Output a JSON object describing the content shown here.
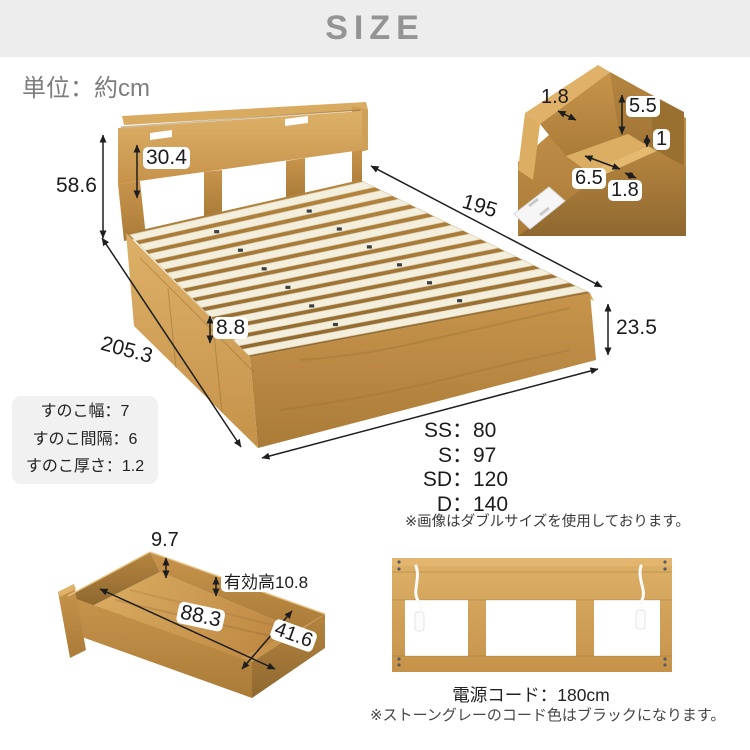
{
  "header": {
    "title": "SIZE"
  },
  "unit_label": "単位：約cm",
  "bed": {
    "total_height": "58.6",
    "headboard_height": "30.4",
    "inner_length": "195",
    "base_height": "23.5",
    "slat_rise": "8.8",
    "total_length": "205.3",
    "widths": [
      {
        "k": "SS",
        "c": "：",
        "v": "80"
      },
      {
        "k": "S",
        "c": "：",
        "v": "97"
      },
      {
        "k": "SD",
        "c": "：",
        "v": "120"
      },
      {
        "k": "D",
        "c": "：",
        "v": "140"
      }
    ],
    "image_note": "※画像はダブルサイズを使用しております。"
  },
  "slat_box": {
    "lines": [
      "すのこ幅：7",
      "すのこ間隔：6",
      "すのこ厚さ：1.2"
    ]
  },
  "corner_detail": {
    "back_thickness": "1.8",
    "shelf_inner_height": "5.5",
    "ledge_step": "1",
    "shelf_depth": "6.5",
    "front_thickness": "1.8"
  },
  "drawer": {
    "wall_height": "9.7",
    "inner_height": "有効高10.8",
    "length": "88.3",
    "width": "41.6"
  },
  "rear": {
    "cord_label": "電源コード：180cm",
    "cord_note": "※ストーングレーのコード色はブラックになります。"
  },
  "colors": {
    "header_bg": "#ededed",
    "header_text": "#949494",
    "wood": "#cd9a52",
    "wood_dark": "#a57632",
    "slat": "#f4eedd",
    "dim_text": "#1b1b1b"
  }
}
